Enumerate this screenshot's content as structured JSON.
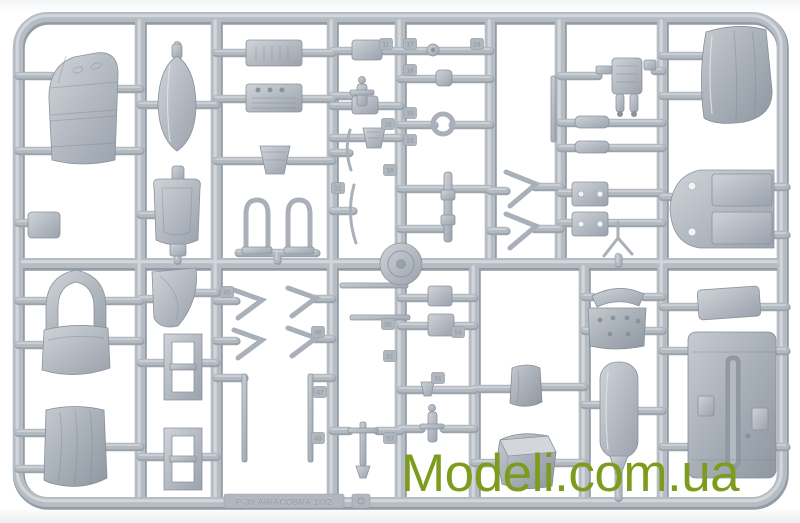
{
  "watermark": {
    "text": "Modeli.com.ua",
    "color": "#7d9c1e"
  },
  "sprue": {
    "molded_text": "P-39 AIRACOBRA 1/32",
    "plastic_color": "#b6bcc4",
    "plastic_shadow": "#939ba5",
    "plastic_highlight": "#d7dadf",
    "background_color": "#ffffff",
    "part_tags": [
      "11",
      "17",
      "18",
      "19",
      "24",
      "15",
      "23",
      "16",
      "21",
      "45",
      "46",
      "47",
      "48",
      "50",
      "51",
      "53",
      "31",
      "54"
    ]
  }
}
